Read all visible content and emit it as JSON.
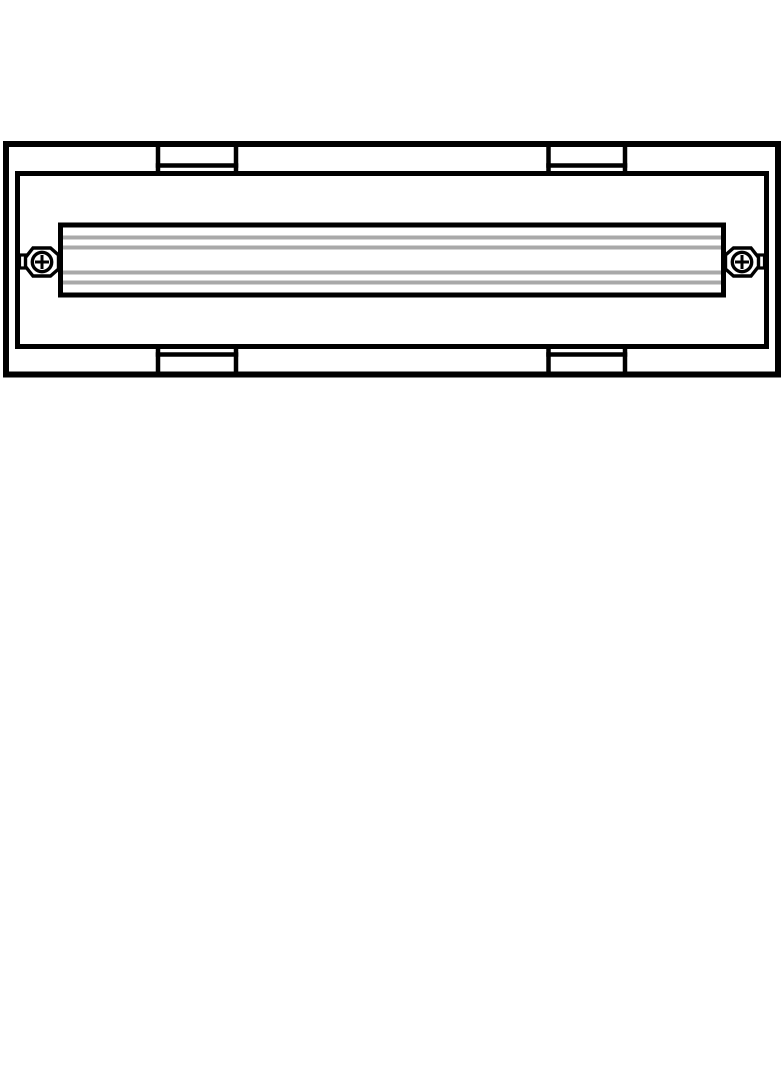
{
  "document": {
    "background_color": "#ffffff",
    "line_color": "#000000",
    "rib_color": "#a9a9a9",
    "fill_color": "#ffffff"
  },
  "drawing": {
    "type": "technical-line-drawing",
    "subject": "rectangular linear fixture, front elevation",
    "components": {
      "outer_frame": "outer-frame",
      "inner_frame": "inner-frame",
      "center_bar": "ribbed-center-bar",
      "rib_count": 4,
      "mount_tabs": [
        "top-left-tab",
        "top-right-tab",
        "bottom-left-tab",
        "bottom-right-tab"
      ],
      "fasteners": [
        "left-captive-phillips-screw",
        "right-captive-phillips-screw"
      ]
    }
  }
}
